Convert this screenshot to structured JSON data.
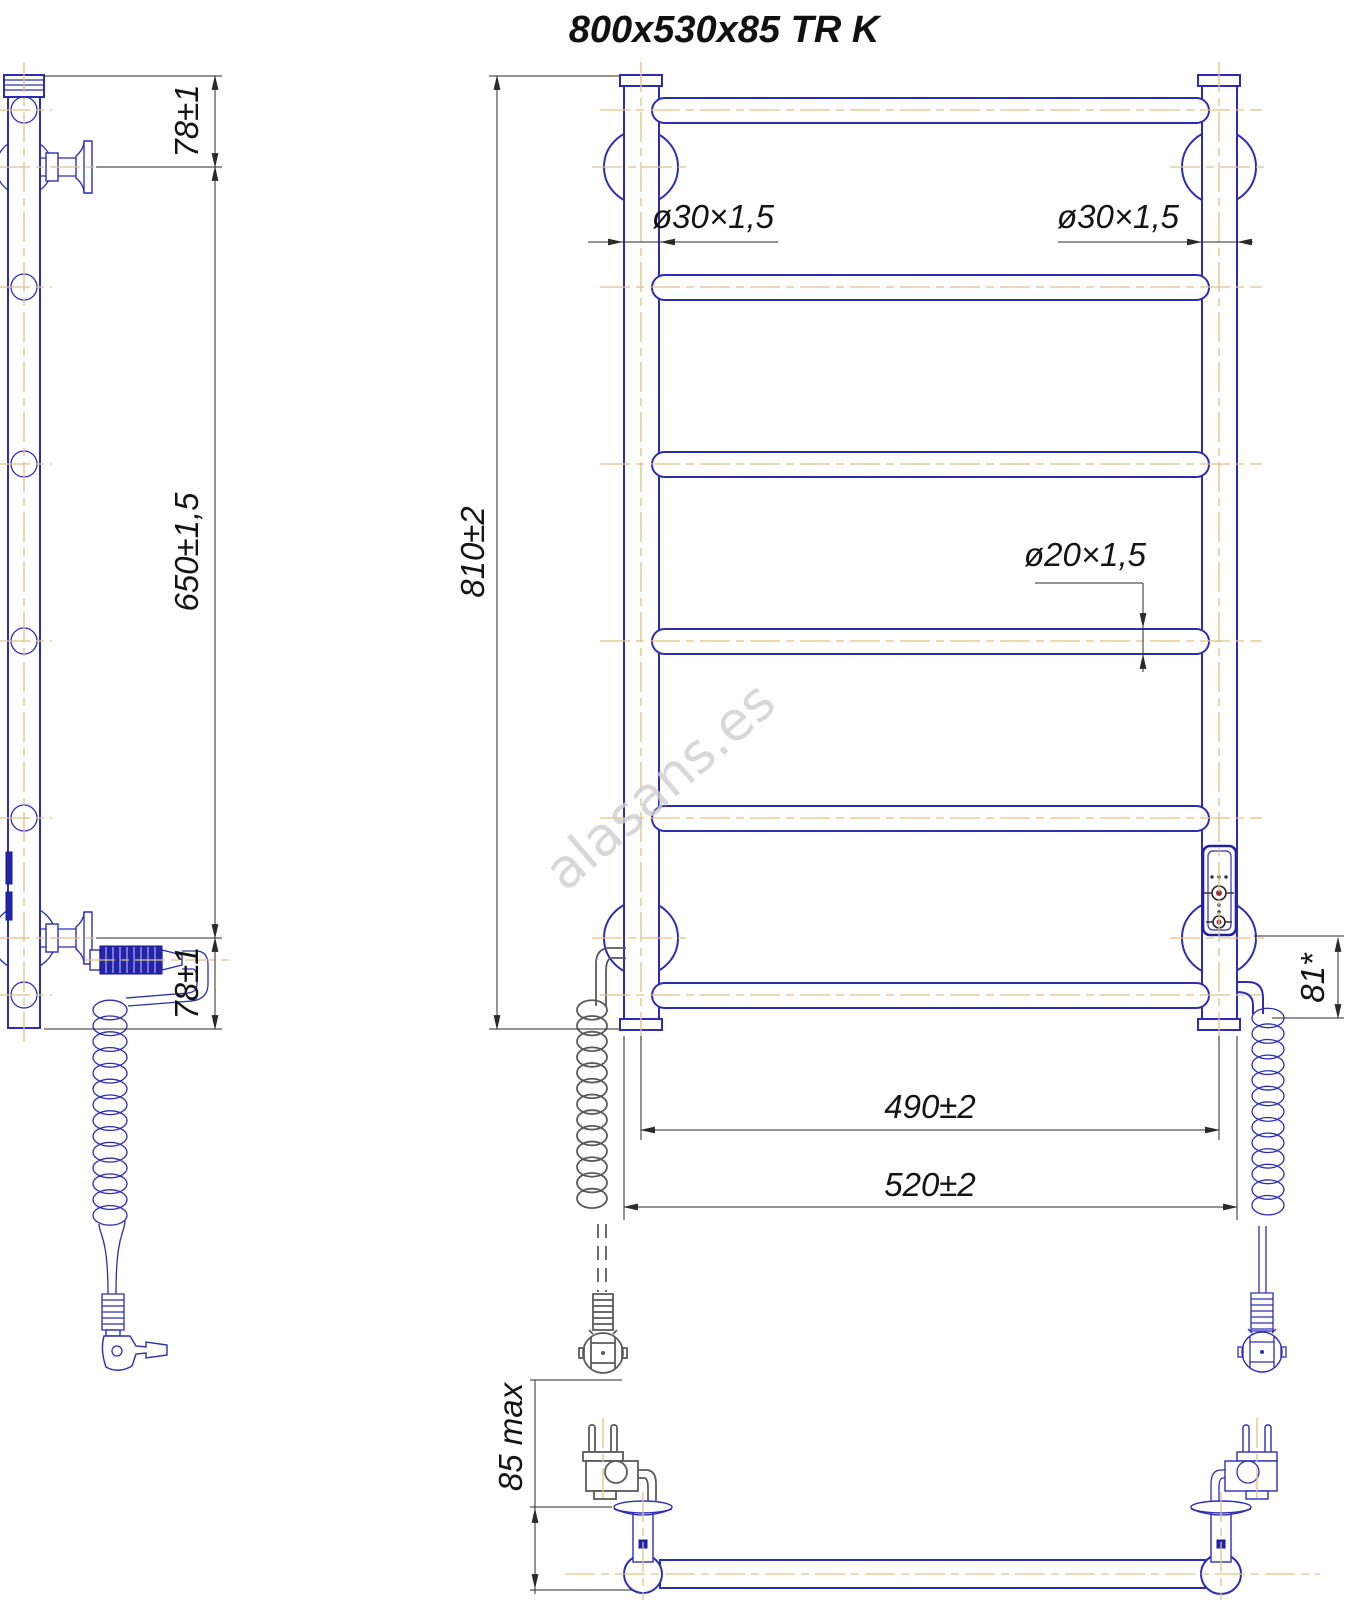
{
  "title": "800x530x85 TR K",
  "watermark": "alasans.es",
  "drawing": {
    "kind": "technical dimensional drawing",
    "product": "electric heated towel rail ladder with coiled power cords and plugs",
    "views": [
      "side view",
      "front view",
      "bottom view"
    ]
  },
  "dims": {
    "side_top_offset": "78±1",
    "side_bracket_span": "650±1,5",
    "side_bottom_offset": "78±1",
    "front_height": "810±2",
    "tube_left_diameter": "ø30×1,5",
    "tube_right_diameter": "ø30×1,5",
    "rung_diameter": "ø20×1,5",
    "bracket_centers_width": "490±2",
    "overall_width": "520±2",
    "cable_offset": "81*",
    "depth_max": "85 max"
  },
  "colors": {
    "outline_blue": "#2d2db4",
    "centerline_tan": "#dcc289",
    "dimension_dark": "#2a2a2a",
    "cable_gray": "#5a5a5a",
    "watermark_gray": "#cfcfcf",
    "background": "#ffffff"
  }
}
